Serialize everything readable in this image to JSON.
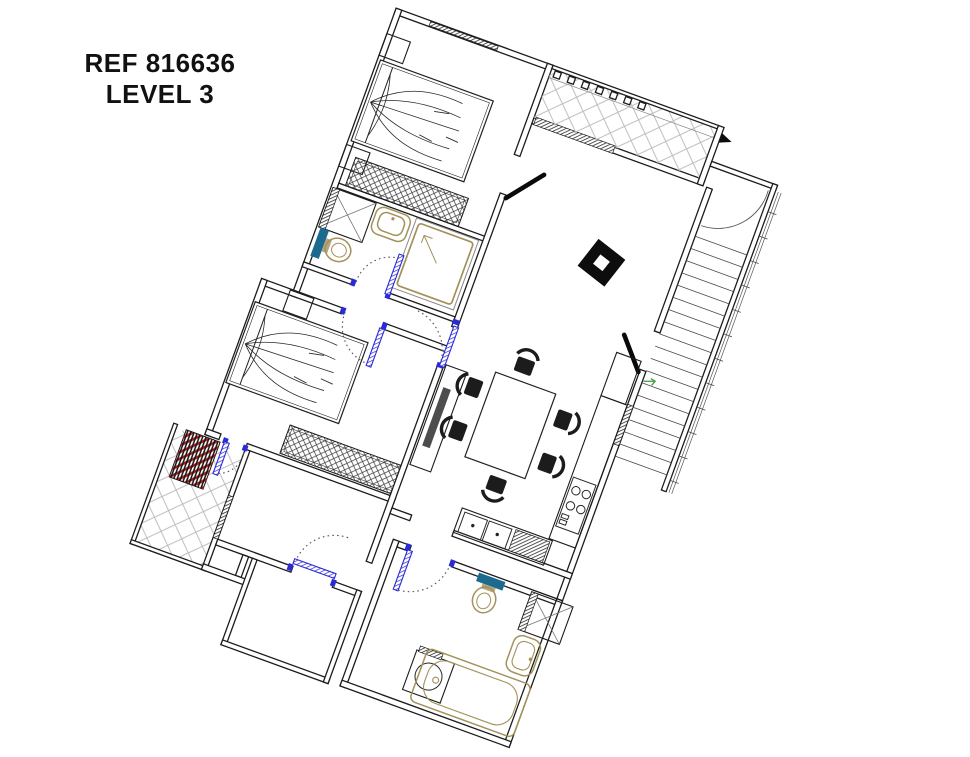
{
  "annotation": {
    "ref": "REF 816636",
    "level": "LEVEL 3"
  },
  "colors": {
    "walls": "#1c1c1c",
    "door_blue": "#2b2bd6",
    "fixture_tan": "#a3915a",
    "tank_teal": "#1c6b8f",
    "ac_red": "#b22020",
    "tile_gray": "#b9b9b9",
    "entry_green": "#3f9d3f"
  },
  "drawing": {
    "type": "apartment-floor-plan",
    "rotation_deg": 20,
    "rooms": [
      "bedroom-1",
      "bathroom-1",
      "hallway",
      "bedroom-2",
      "balcony-left",
      "corridor",
      "living-dining",
      "kitchen",
      "bathroom-2",
      "room-bottom-left",
      "terrace-top",
      "stairwell"
    ],
    "symbols": [
      "double-bed",
      "nightstand",
      "wardrobe",
      "shower",
      "wall-sink",
      "toilet",
      "duct-shaft",
      "dining-table-6-chairs",
      "structural-column",
      "tv-console",
      "fridge",
      "cooktop",
      "double-kitchen-sink",
      "drainer",
      "washing-machine",
      "bathtub",
      "basin",
      "ac-unit",
      "door-swing-arcs",
      "stair-treads",
      "north-arrow"
    ]
  }
}
